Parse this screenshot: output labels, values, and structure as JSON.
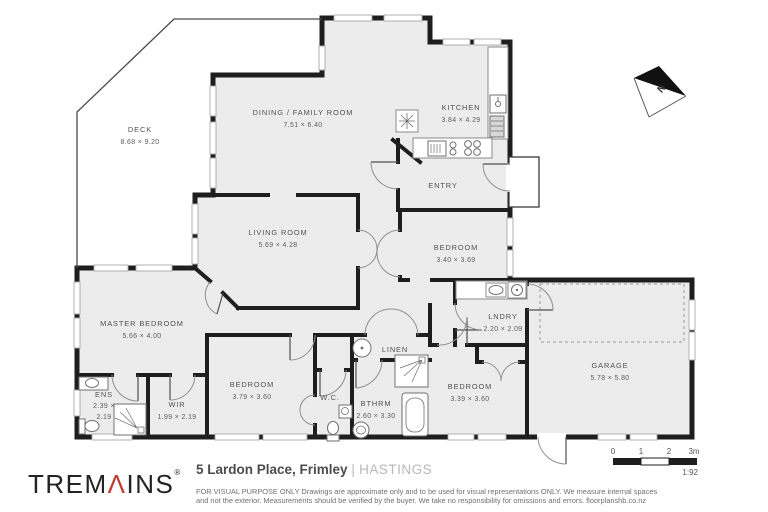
{
  "colors": {
    "wall": "#1e1e1e",
    "floor": "#ececec",
    "accent_red": "#bf3a2f",
    "window_line": "#a8a8a8"
  },
  "plan": {
    "north": "N",
    "rooms": {
      "deck": {
        "name": "DECK",
        "dims": "8.68 × 9.20"
      },
      "dining": {
        "name": "DINING / FAMILY ROOM",
        "dims": "7.51 × 6.40"
      },
      "kitchen": {
        "name": "KITCHEN",
        "dims": "3.84 × 4.29"
      },
      "entry": {
        "name": "ENTRY"
      },
      "living": {
        "name": "LIVING ROOM",
        "dims": "5.69 × 4.28"
      },
      "bedroom_ne": {
        "name": "BEDROOM",
        "dims": "3.40 × 3.69"
      },
      "laundry": {
        "name": "LNDRY",
        "dims": "2.20 × 2.09"
      },
      "garage": {
        "name": "GARAGE",
        "dims": "5.78 × 5.80"
      },
      "master": {
        "name": "MASTER BEDROOM",
        "dims": "5.66 × 4.00"
      },
      "ensuite": {
        "name": "ENS",
        "dims_line1": "2.39 ×",
        "dims_line2": "2.19"
      },
      "wir": {
        "name": "WIR",
        "dims": "1.99 × 2.19"
      },
      "bedroom_sw": {
        "name": "BEDROOM",
        "dims": "3.79 × 3.60"
      },
      "wc": {
        "name": "W.C."
      },
      "bathroom": {
        "name": "BTHRM",
        "dims": "2.60 × 3.30"
      },
      "linen": {
        "name": "LINEN"
      },
      "bedroom_s": {
        "name": "BEDROOM",
        "dims": "3.39 × 3.60"
      }
    },
    "scale_bar": {
      "t0": "0",
      "t1": "1",
      "t2": "2",
      "t3": "3m",
      "ratio": "1:92"
    }
  },
  "footer": {
    "brand": {
      "part1": "TREM",
      "accent": "Λ",
      "part2": "INS",
      "reg": "®"
    },
    "address": "5 Lardon Place, Frimley",
    "separator": "|",
    "region": "HASTINGS",
    "disclaimer_line1": "FOR VISUAL PURPOSE ONLY Drawings are approximate only and to be used for visual representations ONLY. We measure internal spaces",
    "disclaimer_line2": "and not the exterior. Measurements should be verified by the buyer. We take no responsibility for omissions and errors. floorplanshb.co.nz"
  }
}
